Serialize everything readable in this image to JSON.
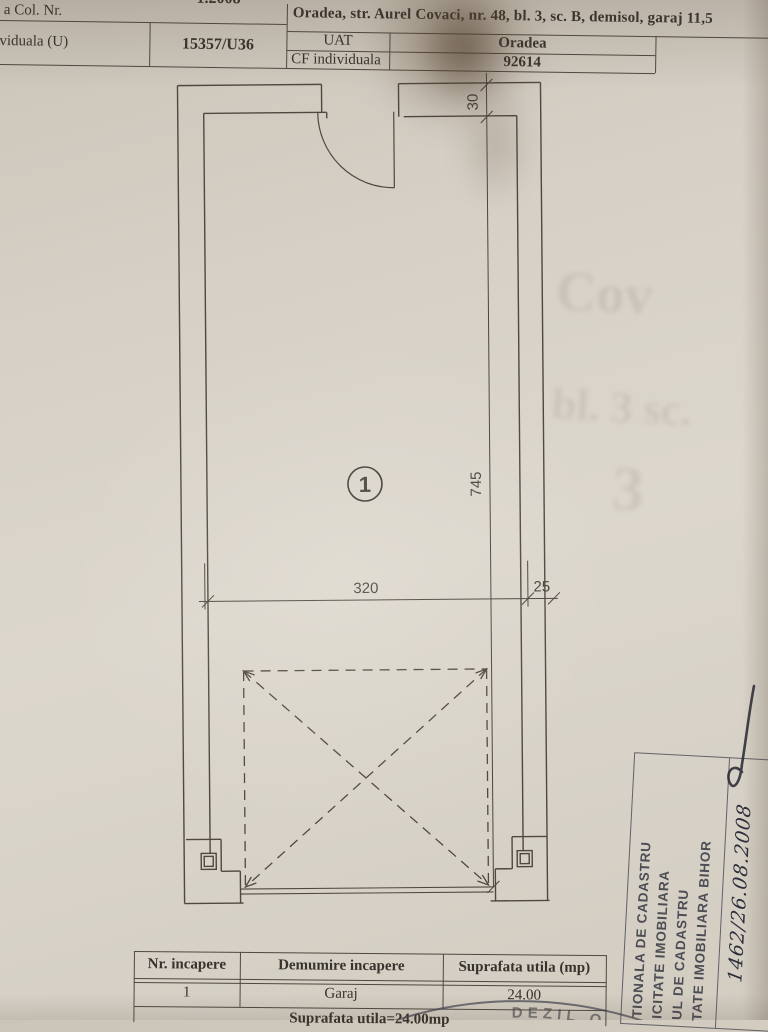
{
  "top_table": {
    "cut_row_remnant": "1.2008",
    "row1_label": "a Col. Nr.",
    "address": "Oradea, str. Aurel Covaci, nr. 48, bl. 3, sc. B, demisol, garaj 11,5",
    "row2_label": "viduala (U)",
    "cf_number": "15357/U36",
    "uat_label": "UAT",
    "uat_value": "Oradea",
    "cf_individuala_label": "CF individuala",
    "cf_individuala_value": "92614"
  },
  "plan": {
    "room_number": "1",
    "dim_width": "320",
    "dim_side": "25",
    "dim_height": "745",
    "dim_wall": "30"
  },
  "rooms_table": {
    "headers": [
      "Nr. incapere",
      "Demumire incapere",
      "Suprafata utila (mp)"
    ],
    "rows": [
      [
        "1",
        "Garaj",
        "24.00"
      ]
    ],
    "total": "Suprafata utila=24.00mp"
  },
  "stamp_right": {
    "lines": [
      "TIONALA DE CADASTRU",
      "ICITATE IMOBILIARA",
      "UL DE CADASTRU",
      "TATE IMOBILIARA BIHOR"
    ],
    "handwritten": "1462/26.08.2008"
  },
  "stamp_round": {
    "letters": "DEZIL O"
  },
  "artifacts": {
    "ghost1": "Cov",
    "ghost2": "bl. 3 sc.",
    "ghost3": "3"
  },
  "colors": {
    "paper": "#d8d2c8",
    "print": "#36322c",
    "plan_line": "#4e483f",
    "stamp_ink": "#40424e"
  }
}
